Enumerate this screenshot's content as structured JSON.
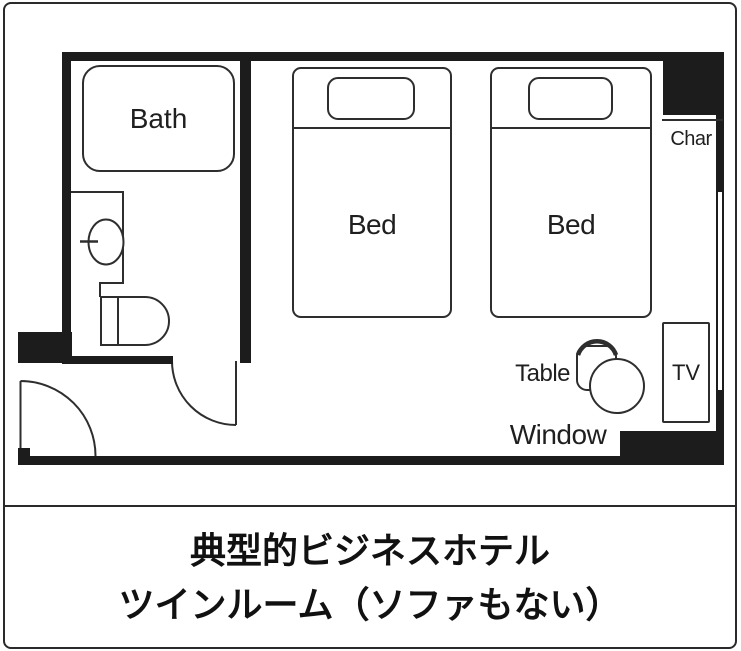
{
  "plan": {
    "labels": {
      "bath": "Bath",
      "bed_left": "Bed",
      "bed_right": "Bed",
      "chair": "Char",
      "table": "Table",
      "tv": "TV",
      "window": "Window"
    }
  },
  "caption": {
    "line1": "典型的ビジネスホテル",
    "line2": "ツインルーム（ソファもない）"
  },
  "colors": {
    "wall": "#1c1c1c",
    "furniture_outline": "#2e2e2e",
    "background": "#ffffff",
    "text": "#1f1f1f"
  }
}
